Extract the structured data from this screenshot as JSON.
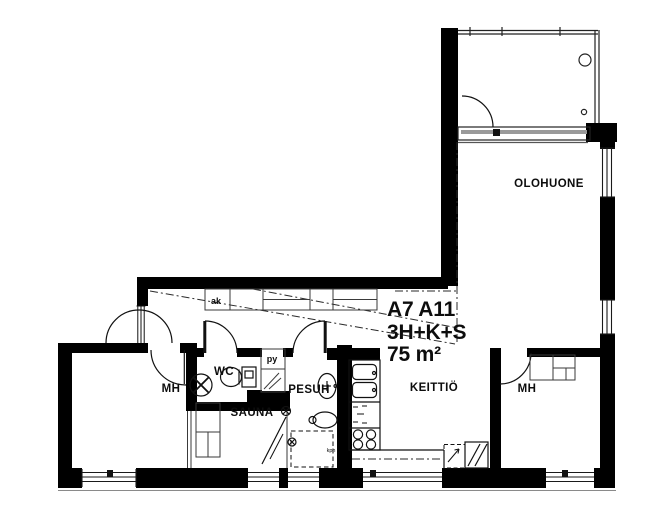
{
  "plan": {
    "unit_id": "A7 A11",
    "unit_type": "3H+K+S",
    "unit_area": "75 m²",
    "rooms": {
      "living_room": "OLOHUONE",
      "kitchen": "KEITTIÖ",
      "bedroom_left": "MH",
      "bedroom_right": "MH",
      "wc": "WC",
      "washroom": "PESUH",
      "sauna": "SAUNA"
    },
    "closets": {
      "hall_closet": "ak",
      "linen_closet": "py"
    },
    "annotations": {
      "washroom_note": "kph"
    },
    "colors": {
      "wall": "#000000",
      "line": "#1a1a1a",
      "glass_tint": "#9a9a9a",
      "background": "#ffffff"
    }
  }
}
